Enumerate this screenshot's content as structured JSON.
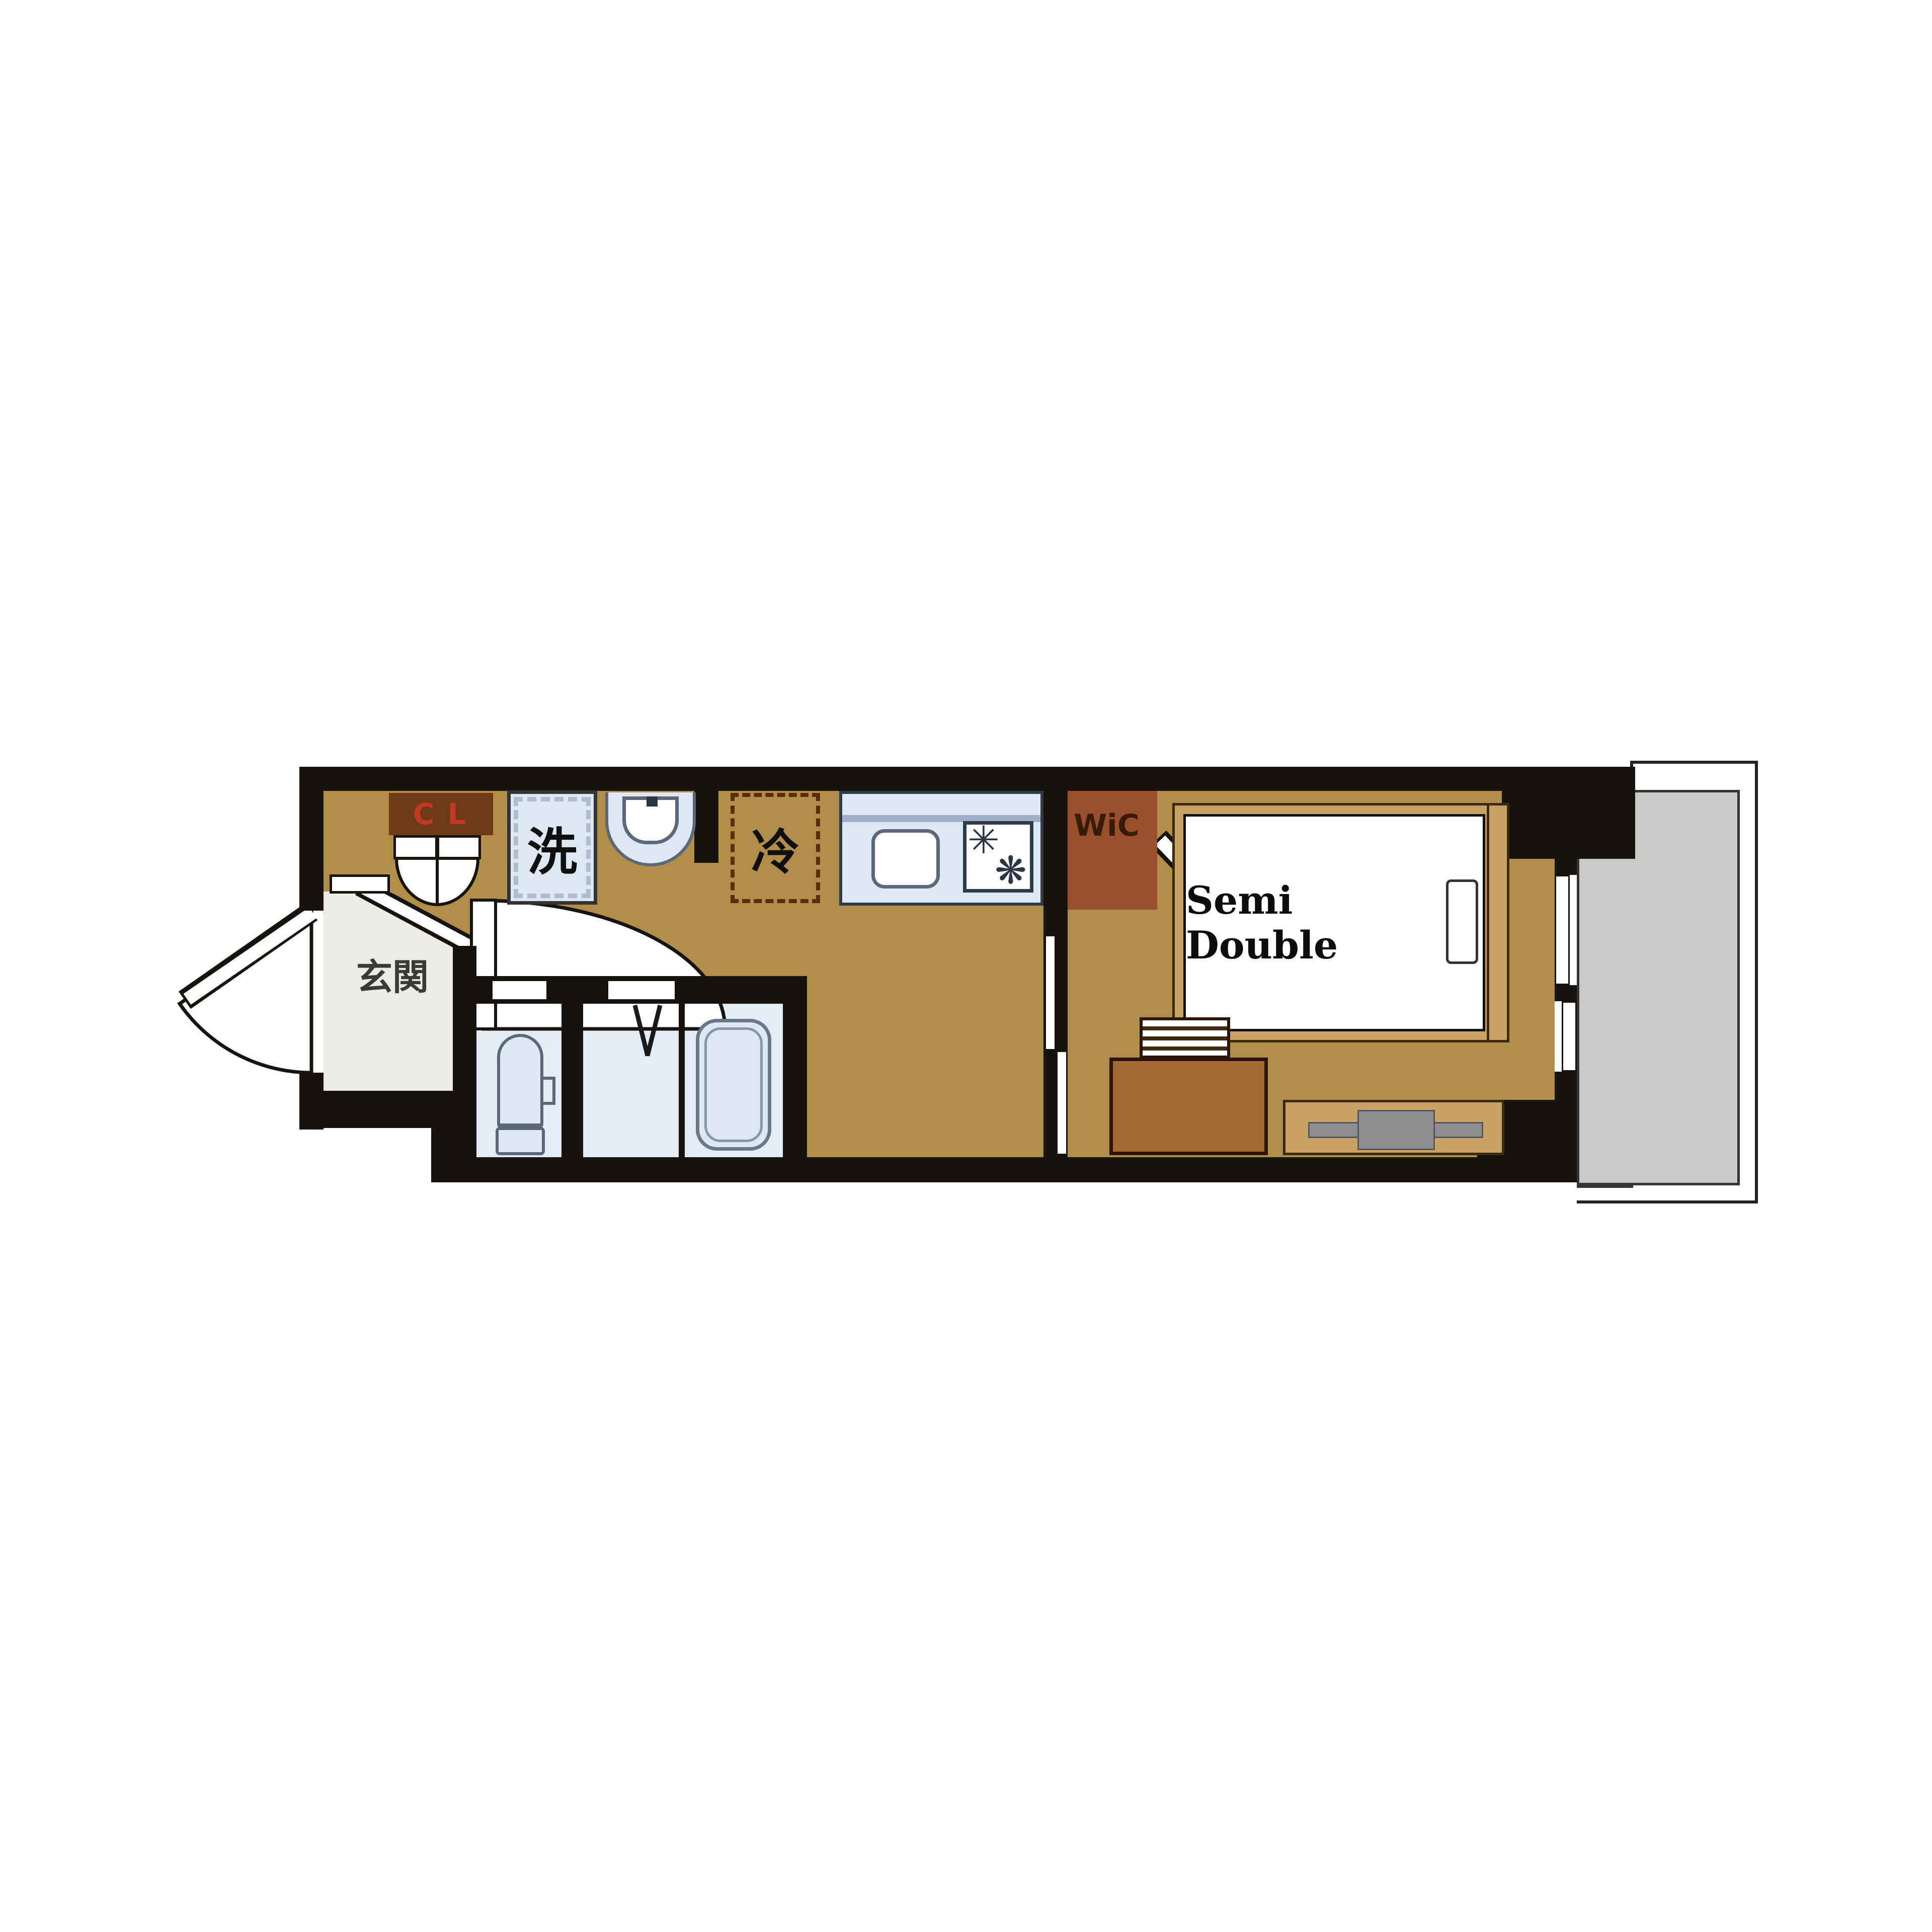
{
  "plan": {
    "type": "apartment-floor-plan",
    "labels": {
      "entrance": "玄関",
      "closet": "CL",
      "washer": "洗",
      "refrigerator": "冷",
      "walk_in_closet": "WiC",
      "bed": "Semi Double"
    },
    "icons": {
      "burner_left_icon": "✳",
      "burner_right_icon": "❋"
    },
    "rooms": [
      {
        "name": "entrance-genkan",
        "label": "玄関"
      },
      {
        "name": "hallway-kitchen",
        "label": ""
      },
      {
        "name": "toilet-room",
        "label": ""
      },
      {
        "name": "vanity-room",
        "label": ""
      },
      {
        "name": "bathroom-tub",
        "label": ""
      },
      {
        "name": "bedroom",
        "label": "Semi Double"
      },
      {
        "name": "walk-in-closet",
        "label": "WiC"
      },
      {
        "name": "closet",
        "label": "CL"
      },
      {
        "name": "balcony",
        "label": ""
      }
    ],
    "colors": {
      "wall": "#17130e",
      "floor_tan": "#b08e48",
      "floor_entry": "#eceae4",
      "floor_wet": "#e3ecf5",
      "fixture_fill": "#dce7f2",
      "fixture_outline": "#5c687a",
      "counter_fill": "#dde8f3",
      "closet_fill": "#6e3a17",
      "closet_text": "#c03a20",
      "wic_fill": "#9a4e2a",
      "bed_frame": "#c9a265",
      "desk_fill": "#a26b33",
      "tv_gray": "#8c8e90",
      "balcony_floor": "#c9c9c7",
      "fridge_dash": "#54300d"
    }
  }
}
